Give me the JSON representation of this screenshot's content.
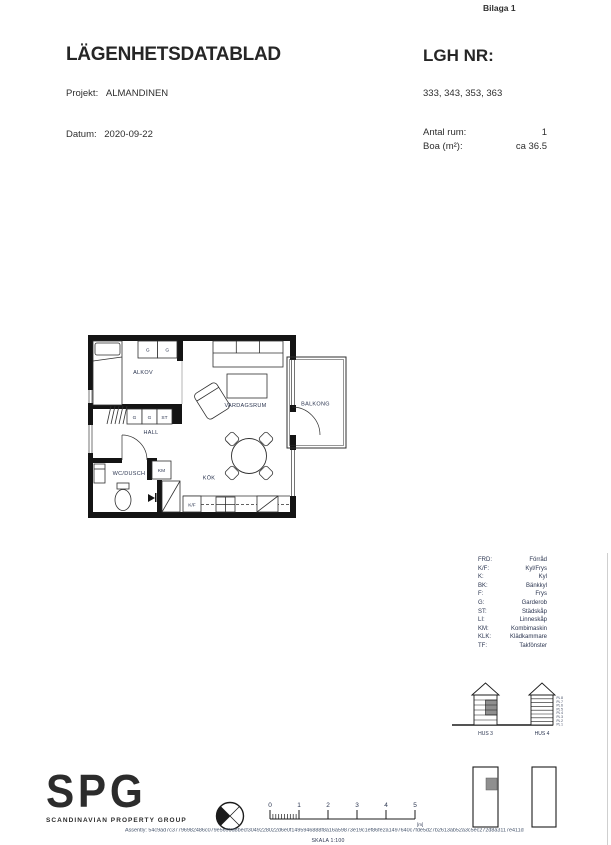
{
  "page": {
    "bilaga": "Bilaga 1"
  },
  "header": {
    "title": "LÄGENHETSDATABLAD",
    "lgh_nr_label": "LGH NR:",
    "lgh_numbers": "333, 343, 353, 363",
    "projekt_label": "Projekt:",
    "projekt_value": "ALMANDINEN",
    "datum_label": "Datum:",
    "datum_value": "2020-09-22",
    "antal_rum_label": "Antal rum:",
    "antal_rum_value": "1",
    "boa_label": "Boa (m²):",
    "boa_value": "ca 36.5"
  },
  "floorplan": {
    "rooms": {
      "alkov": "ALKOV",
      "hall": "HALL",
      "wc": "WC/DUSCH",
      "kok": "KÖK",
      "vardagsrum": "VARDAGSRUM",
      "balkong": "BALKONG"
    },
    "fixtures": {
      "g": "G",
      "st": "ST",
      "km": "KM",
      "kf": "K/F"
    }
  },
  "legend": {
    "items": [
      {
        "abbr": "FRD:",
        "name": "Förråd"
      },
      {
        "abbr": "K/F:",
        "name": "Kyl/Frys"
      },
      {
        "abbr": "K:",
        "name": "Kyl"
      },
      {
        "abbr": "BK:",
        "name": "Bänkkyl"
      },
      {
        "abbr": "F:",
        "name": "Frys"
      },
      {
        "abbr": "G:",
        "name": "Garderob"
      },
      {
        "abbr": "ST:",
        "name": "Städskåp"
      },
      {
        "abbr": "LI:",
        "name": "Linneskåp"
      },
      {
        "abbr": "KM:",
        "name": "Kombimaskin"
      },
      {
        "abbr": "KLK:",
        "name": "Klädkammare"
      },
      {
        "abbr": "TF:",
        "name": "Takfönster"
      }
    ]
  },
  "buildings": {
    "hus3_label": "HUS 3",
    "hus4_label": "HUS 4",
    "floor_labels": [
      "PL 8",
      "PL 7",
      "PL 6",
      "PL 5",
      "PL 4",
      "PL 3",
      "PL 2",
      "PL 1"
    ]
  },
  "scalebar": {
    "ticks": [
      "0",
      "1",
      "2",
      "3",
      "4",
      "5"
    ],
    "unit": "[m]",
    "skala": "SKALA 1:100"
  },
  "logo": {
    "text": "SPG",
    "subtext": "SCANDINAVIAN PROPERTY GROUP"
  },
  "footer": {
    "assently": "Assently: 54c9ad7c37796982486c079e5695d8becf3049228022d6e0f1495946888f8a16a59873e19c1ef86fe2a1497640c7fde5d27b2613ab52a3c5ec272d8a3117e411d"
  },
  "colors": {
    "ink": "#262626",
    "plan_text": "#2b3550",
    "wall": "#141414",
    "gray_fill": "#8f8f8f"
  }
}
